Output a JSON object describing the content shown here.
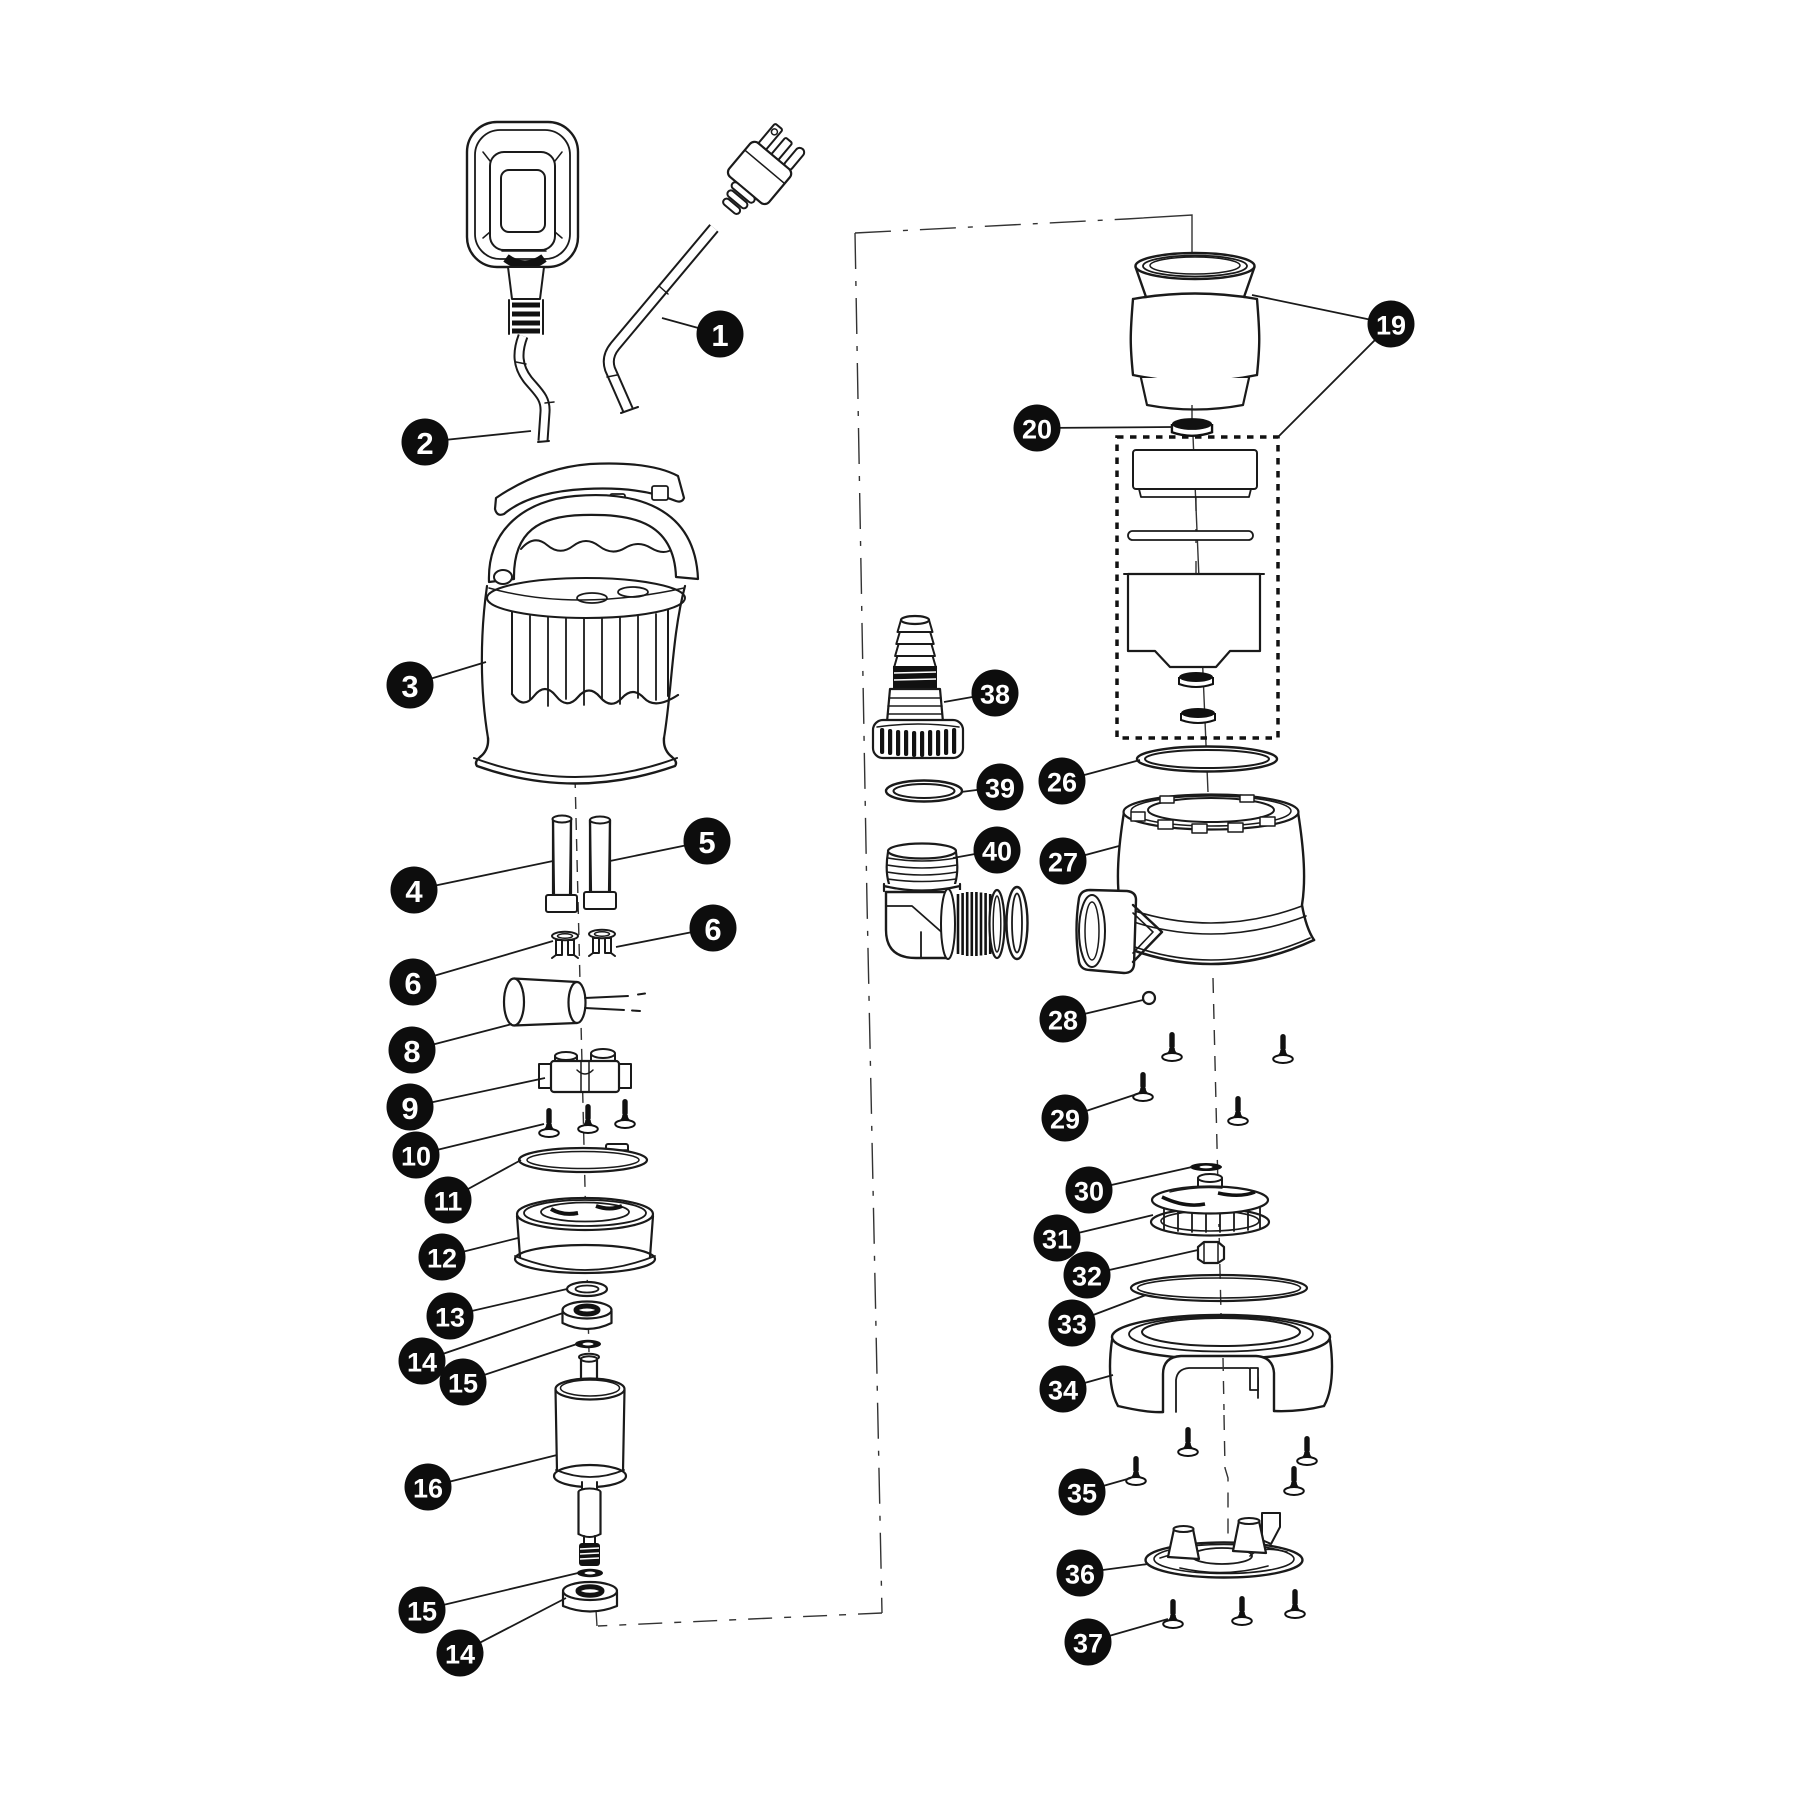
{
  "figure": {
    "type": "exploded-parts-diagram",
    "subject": "submersible-pump",
    "background": "#ffffff",
    "line_color": "#1a1a1a"
  },
  "callout_style": {
    "radius": 23.5,
    "fill": "#0d0d0d",
    "text_color": "#ffffff",
    "font_size_1digit": 31,
    "font_size_2digit": 27,
    "leader_color": "#1a1a1a",
    "leader_width": 1.8
  },
  "callouts": [
    {
      "label": "1",
      "x": 720,
      "y": 334,
      "targets": [
        [
          662,
          318
        ]
      ]
    },
    {
      "label": "2",
      "x": 425,
      "y": 442,
      "targets": [
        [
          531,
          431
        ]
      ]
    },
    {
      "label": "3",
      "x": 410,
      "y": 685,
      "targets": [
        [
          486,
          662
        ]
      ]
    },
    {
      "label": "4",
      "x": 414,
      "y": 890,
      "targets": [
        [
          553,
          861
        ]
      ]
    },
    {
      "label": "5",
      "x": 707,
      "y": 841,
      "targets": [
        [
          610,
          861
        ]
      ]
    },
    {
      "label": "6",
      "x": 713,
      "y": 928,
      "targets": [
        [
          616,
          947
        ]
      ]
    },
    {
      "label": "6",
      "x": 413,
      "y": 982,
      "targets": [
        [
          553,
          941
        ]
      ]
    },
    {
      "label": "8",
      "x": 412,
      "y": 1050,
      "targets": [
        [
          512,
          1024
        ]
      ]
    },
    {
      "label": "9",
      "x": 410,
      "y": 1107,
      "targets": [
        [
          545,
          1078
        ]
      ]
    },
    {
      "label": "10",
      "x": 416,
      "y": 1155,
      "targets": [
        [
          544,
          1124
        ]
      ]
    },
    {
      "label": "11",
      "x": 448,
      "y": 1200,
      "targets": [
        [
          521,
          1160
        ]
      ]
    },
    {
      "label": "12",
      "x": 442,
      "y": 1257,
      "targets": [
        [
          518,
          1238
        ]
      ]
    },
    {
      "label": "13",
      "x": 450,
      "y": 1316,
      "targets": [
        [
          567,
          1289
        ]
      ]
    },
    {
      "label": "14",
      "x": 422,
      "y": 1361,
      "targets": [
        [
          563,
          1313
        ]
      ]
    },
    {
      "label": "15",
      "x": 463,
      "y": 1382,
      "targets": [
        [
          577,
          1344
        ]
      ]
    },
    {
      "label": "16",
      "x": 428,
      "y": 1487,
      "targets": [
        [
          557,
          1455
        ]
      ]
    },
    {
      "label": "15",
      "x": 422,
      "y": 1610,
      "targets": [
        [
          578,
          1573
        ]
      ]
    },
    {
      "label": "14",
      "x": 460,
      "y": 1653,
      "targets": [
        [
          566,
          1598
        ]
      ]
    },
    {
      "label": "19",
      "x": 1391,
      "y": 324,
      "targets": [
        [
          1252,
          295
        ],
        [
          1278,
          437
        ]
      ]
    },
    {
      "label": "20",
      "x": 1037,
      "y": 428,
      "targets": [
        [
          1173,
          427
        ]
      ]
    },
    {
      "label": "26",
      "x": 1062,
      "y": 781,
      "targets": [
        [
          1140,
          760
        ]
      ]
    },
    {
      "label": "27",
      "x": 1063,
      "y": 861,
      "targets": [
        [
          1119,
          846
        ]
      ]
    },
    {
      "label": "28",
      "x": 1063,
      "y": 1019,
      "targets": [
        [
          1143,
          1000
        ]
      ]
    },
    {
      "label": "29",
      "x": 1065,
      "y": 1118,
      "targets": [
        [
          1137,
          1094
        ]
      ]
    },
    {
      "label": "30",
      "x": 1089,
      "y": 1190,
      "targets": [
        [
          1192,
          1167
        ]
      ]
    },
    {
      "label": "31",
      "x": 1057,
      "y": 1238,
      "targets": [
        [
          1153,
          1215
        ]
      ]
    },
    {
      "label": "32",
      "x": 1087,
      "y": 1275,
      "targets": [
        [
          1198,
          1250
        ]
      ]
    },
    {
      "label": "33",
      "x": 1072,
      "y": 1323,
      "targets": [
        [
          1146,
          1295
        ]
      ]
    },
    {
      "label": "34",
      "x": 1063,
      "y": 1389,
      "targets": [
        [
          1113,
          1375
        ]
      ]
    },
    {
      "label": "35",
      "x": 1082,
      "y": 1492,
      "targets": [
        [
          1131,
          1478
        ]
      ]
    },
    {
      "label": "36",
      "x": 1080,
      "y": 1573,
      "targets": [
        [
          1148,
          1564
        ]
      ]
    },
    {
      "label": "37",
      "x": 1088,
      "y": 1642,
      "targets": [
        [
          1168,
          1619
        ]
      ]
    },
    {
      "label": "38",
      "x": 995,
      "y": 693,
      "targets": [
        [
          944,
          702
        ]
      ]
    },
    {
      "label": "39",
      "x": 1000,
      "y": 787,
      "targets": [
        [
          961,
          792
        ]
      ]
    },
    {
      "label": "40",
      "x": 997,
      "y": 850,
      "targets": [
        [
          953,
          858
        ]
      ]
    }
  ]
}
